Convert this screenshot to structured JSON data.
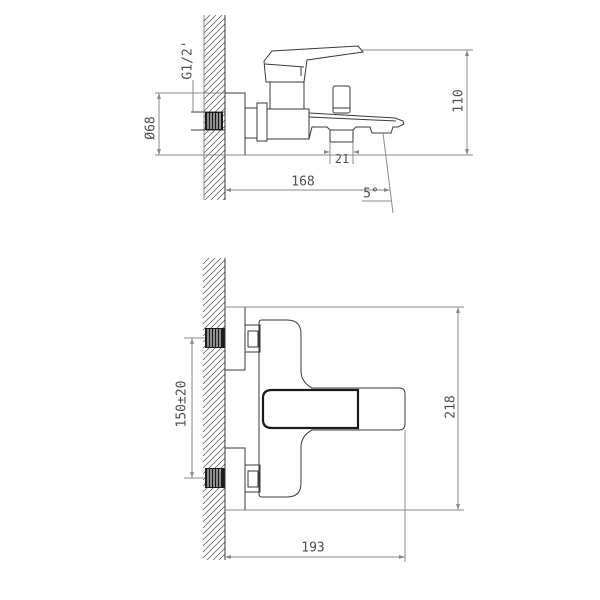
{
  "drawing": {
    "background_color": "#ffffff",
    "outline_color": "#3a3a3a",
    "dimension_color": "#8a8a8a",
    "text_color": "#4f4f4f",
    "side_view": {
      "thread_label": "G1/2'",
      "flange_diameter_label": "Ø68",
      "body_height_label": "110",
      "wall_to_outlet_label": "168",
      "outlet_width_label": "21",
      "spout_angle_label": "5°"
    },
    "front_view": {
      "inlet_spacing_label": "150±20",
      "overall_height_label": "218",
      "wall_to_handle_label": "193"
    }
  }
}
